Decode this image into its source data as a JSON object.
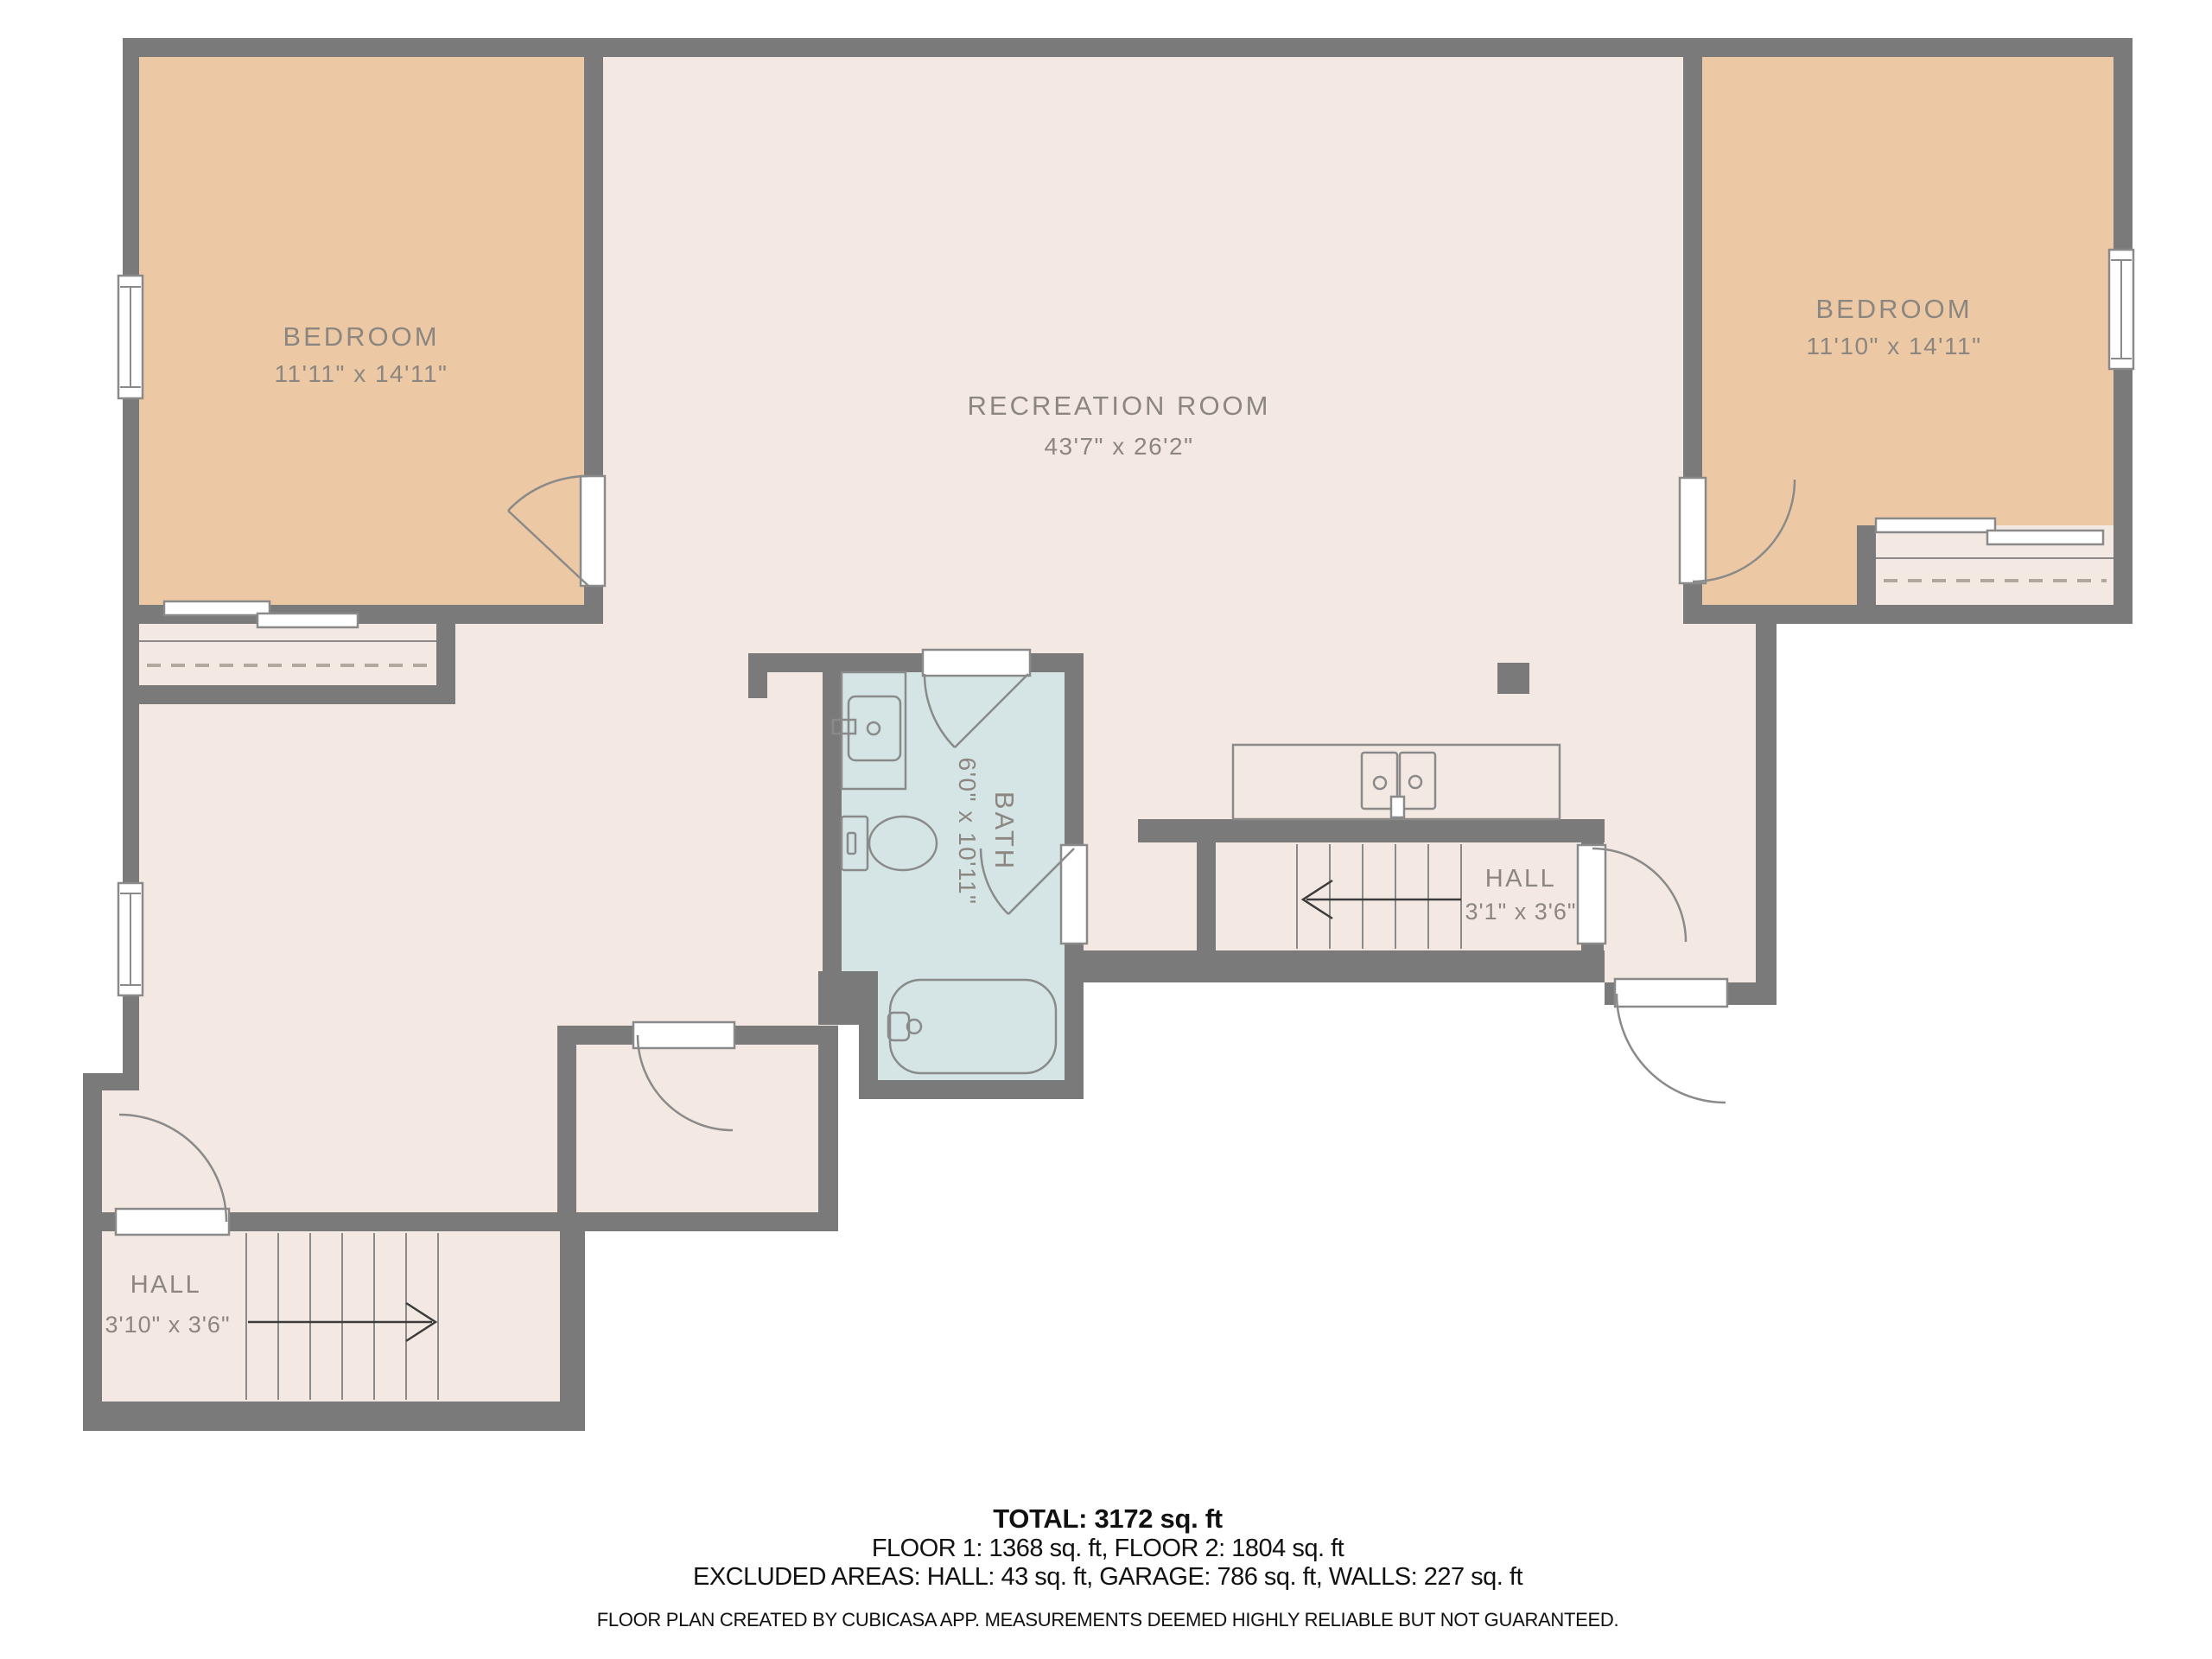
{
  "colors": {
    "wall": "#7a7a7a",
    "floor": "#f3e9e2",
    "bedroom": "#ecc9a4",
    "bath": "#d5e4e4",
    "fixture": "#8a8a8a",
    "label": "#8c8680",
    "dash": "#b3a89e",
    "arrow": "#3c3c3c",
    "text": "#111111"
  },
  "rooms": {
    "bedroom_left": {
      "name": "BEDROOM",
      "dims": "11'11\" x 14'11\""
    },
    "recreation": {
      "name": "RECREATION ROOM",
      "dims": "43'7\" x 26'2\""
    },
    "bedroom_right": {
      "name": "BEDROOM",
      "dims": "11'10\" x 14'11\""
    },
    "bath": {
      "name": "BATH",
      "dims": "6'0\" x 10'11\""
    },
    "hall_upper": {
      "name": "HALL",
      "dims": "3'1\" x 3'6\""
    },
    "hall_lower": {
      "name": "HALL",
      "dims": "3'10\" x 3'6\""
    }
  },
  "summary": {
    "total": "TOTAL: 3172 sq. ft",
    "floors": "FLOOR 1: 1368 sq. ft, FLOOR 2: 1804 sq. ft",
    "excluded": "EXCLUDED AREAS: HALL: 43 sq. ft, GARAGE: 786 sq. ft, WALLS: 227 sq. ft",
    "disclaimer": "FLOOR PLAN CREATED BY CUBICASA APP. MEASUREMENTS DEEMED HIGHLY RELIABLE BUT NOT GUARANTEED."
  }
}
